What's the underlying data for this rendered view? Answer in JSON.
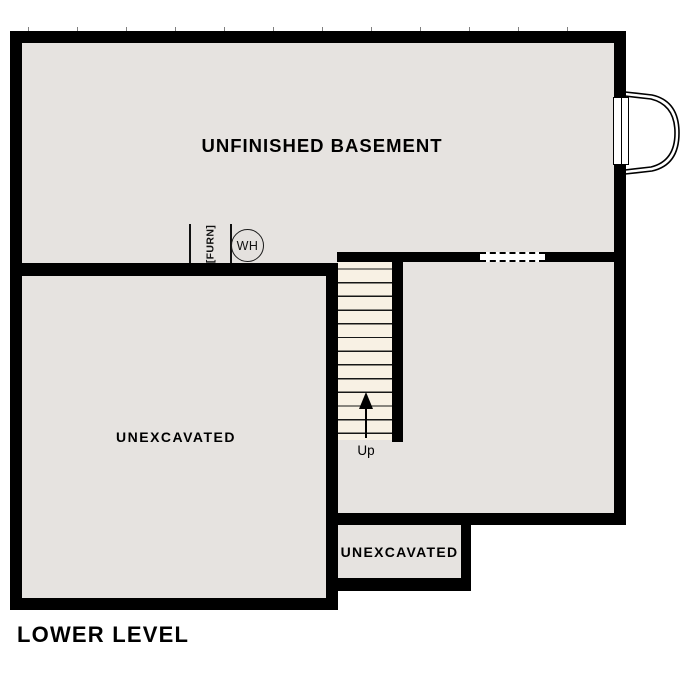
{
  "page_title": "LOWER LEVEL",
  "plan": {
    "rooms": [
      {
        "id": "unfinished-basement",
        "label": "UNFINISHED BASEMENT"
      },
      {
        "id": "unexcavated-left",
        "label": "UNEXCAVATED"
      },
      {
        "id": "unexcavated-small",
        "label": "UNEXCAVATED"
      }
    ],
    "stairs": {
      "direction_label": "Up",
      "step_count": 13
    },
    "fixtures": {
      "furnace_label": "[FURN]",
      "water_heater_label": "WH"
    }
  },
  "icons": {
    "bay_window": "bow-window-icon",
    "wall_opening": "dashed-opening",
    "up_arrow": "up-arrow-icon"
  },
  "colors": {
    "wall": "#000000",
    "floor": "#e6e3e0",
    "stair_tread": "#f8f1e4",
    "background": "#ffffff"
  }
}
